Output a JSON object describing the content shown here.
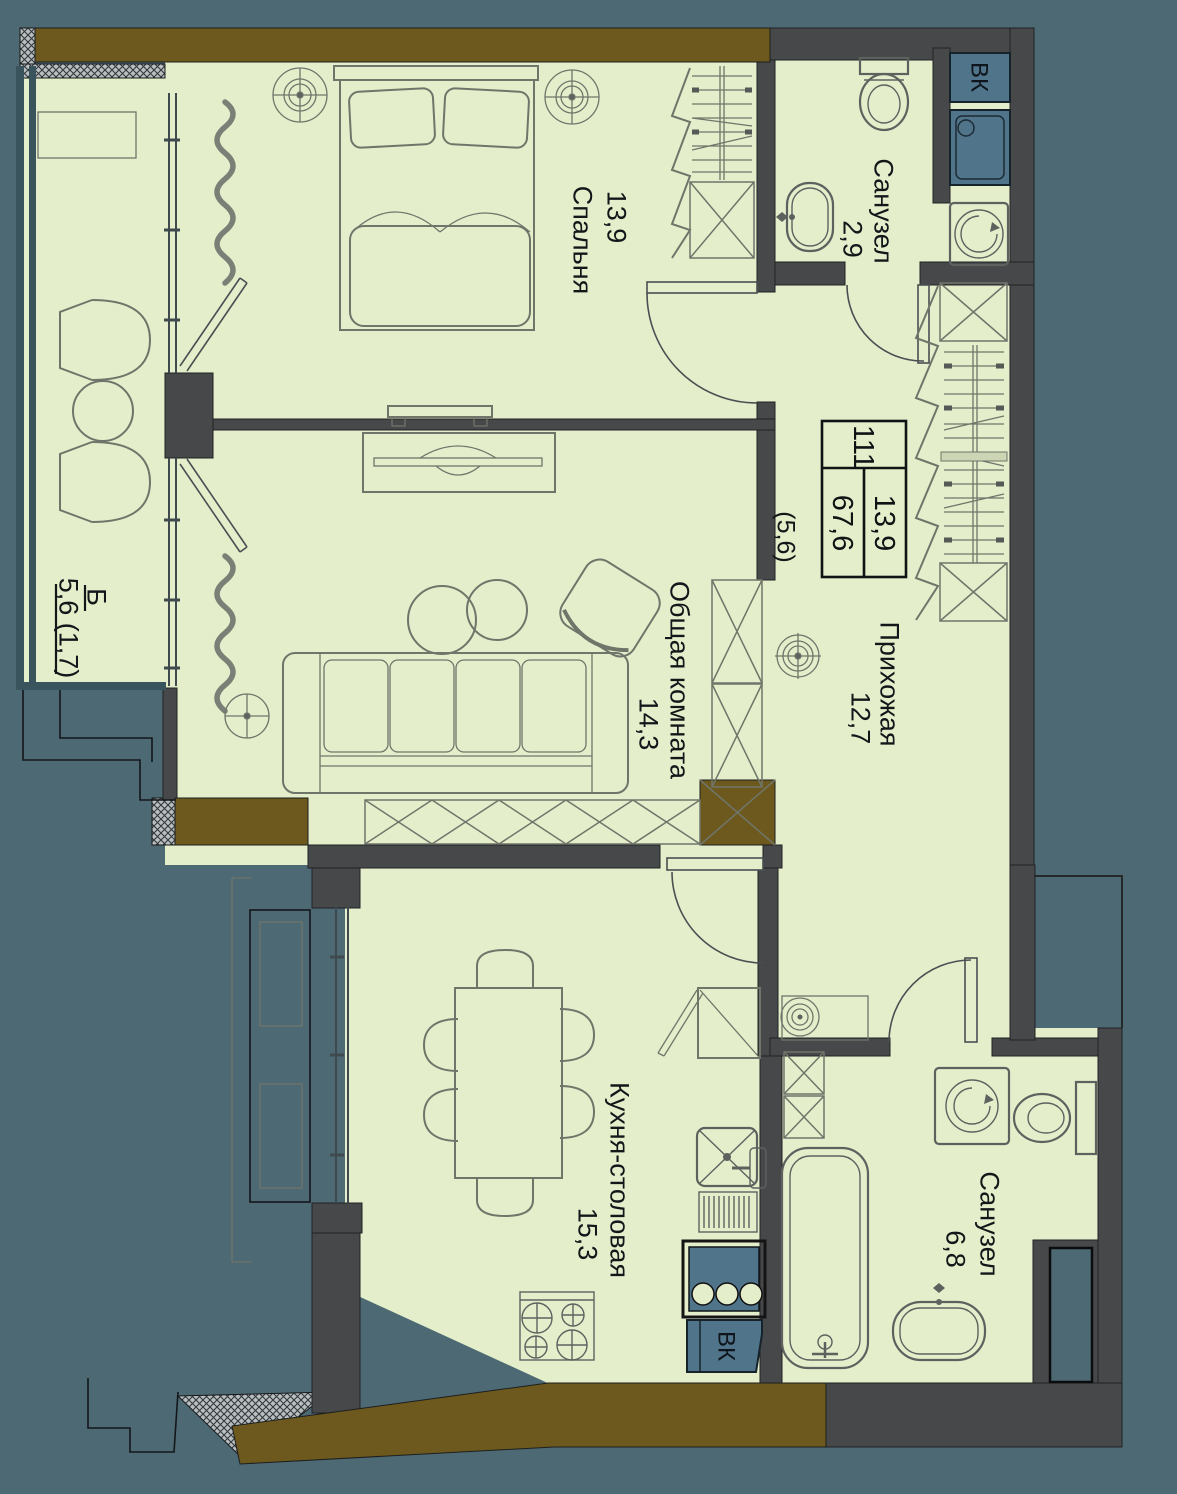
{
  "floor_plan": {
    "rooms": [
      {
        "key": "bedroom",
        "name": "Спальня",
        "area": "13,9"
      },
      {
        "key": "bathroom-top",
        "name": "Санузел",
        "area": "2,9"
      },
      {
        "key": "living-room",
        "name": "Общая комната",
        "area": "14,3"
      },
      {
        "key": "hallway",
        "name": "Прихожая",
        "area": "12,7"
      },
      {
        "key": "kitchen-dining",
        "name": "Кухня-столовая",
        "area": "15,3"
      },
      {
        "key": "bathroom-bottom",
        "name": "Санузел",
        "area": "6,8"
      },
      {
        "key": "balcony",
        "name": "Б",
        "area": "5,6 (1,7)"
      }
    ],
    "stamp": {
      "apartment_number": "111",
      "total_area": "67,6",
      "living_area": "13,9",
      "balcony_note": "(5,6)"
    },
    "vents": {
      "top": "ВК",
      "bottom": "ВК"
    },
    "colors": {
      "background": "#4d6973",
      "floor": "#e4eecb",
      "walls": "#474849",
      "accent_wall": "#6d591d",
      "fixture_blue": "#50748a"
    }
  }
}
